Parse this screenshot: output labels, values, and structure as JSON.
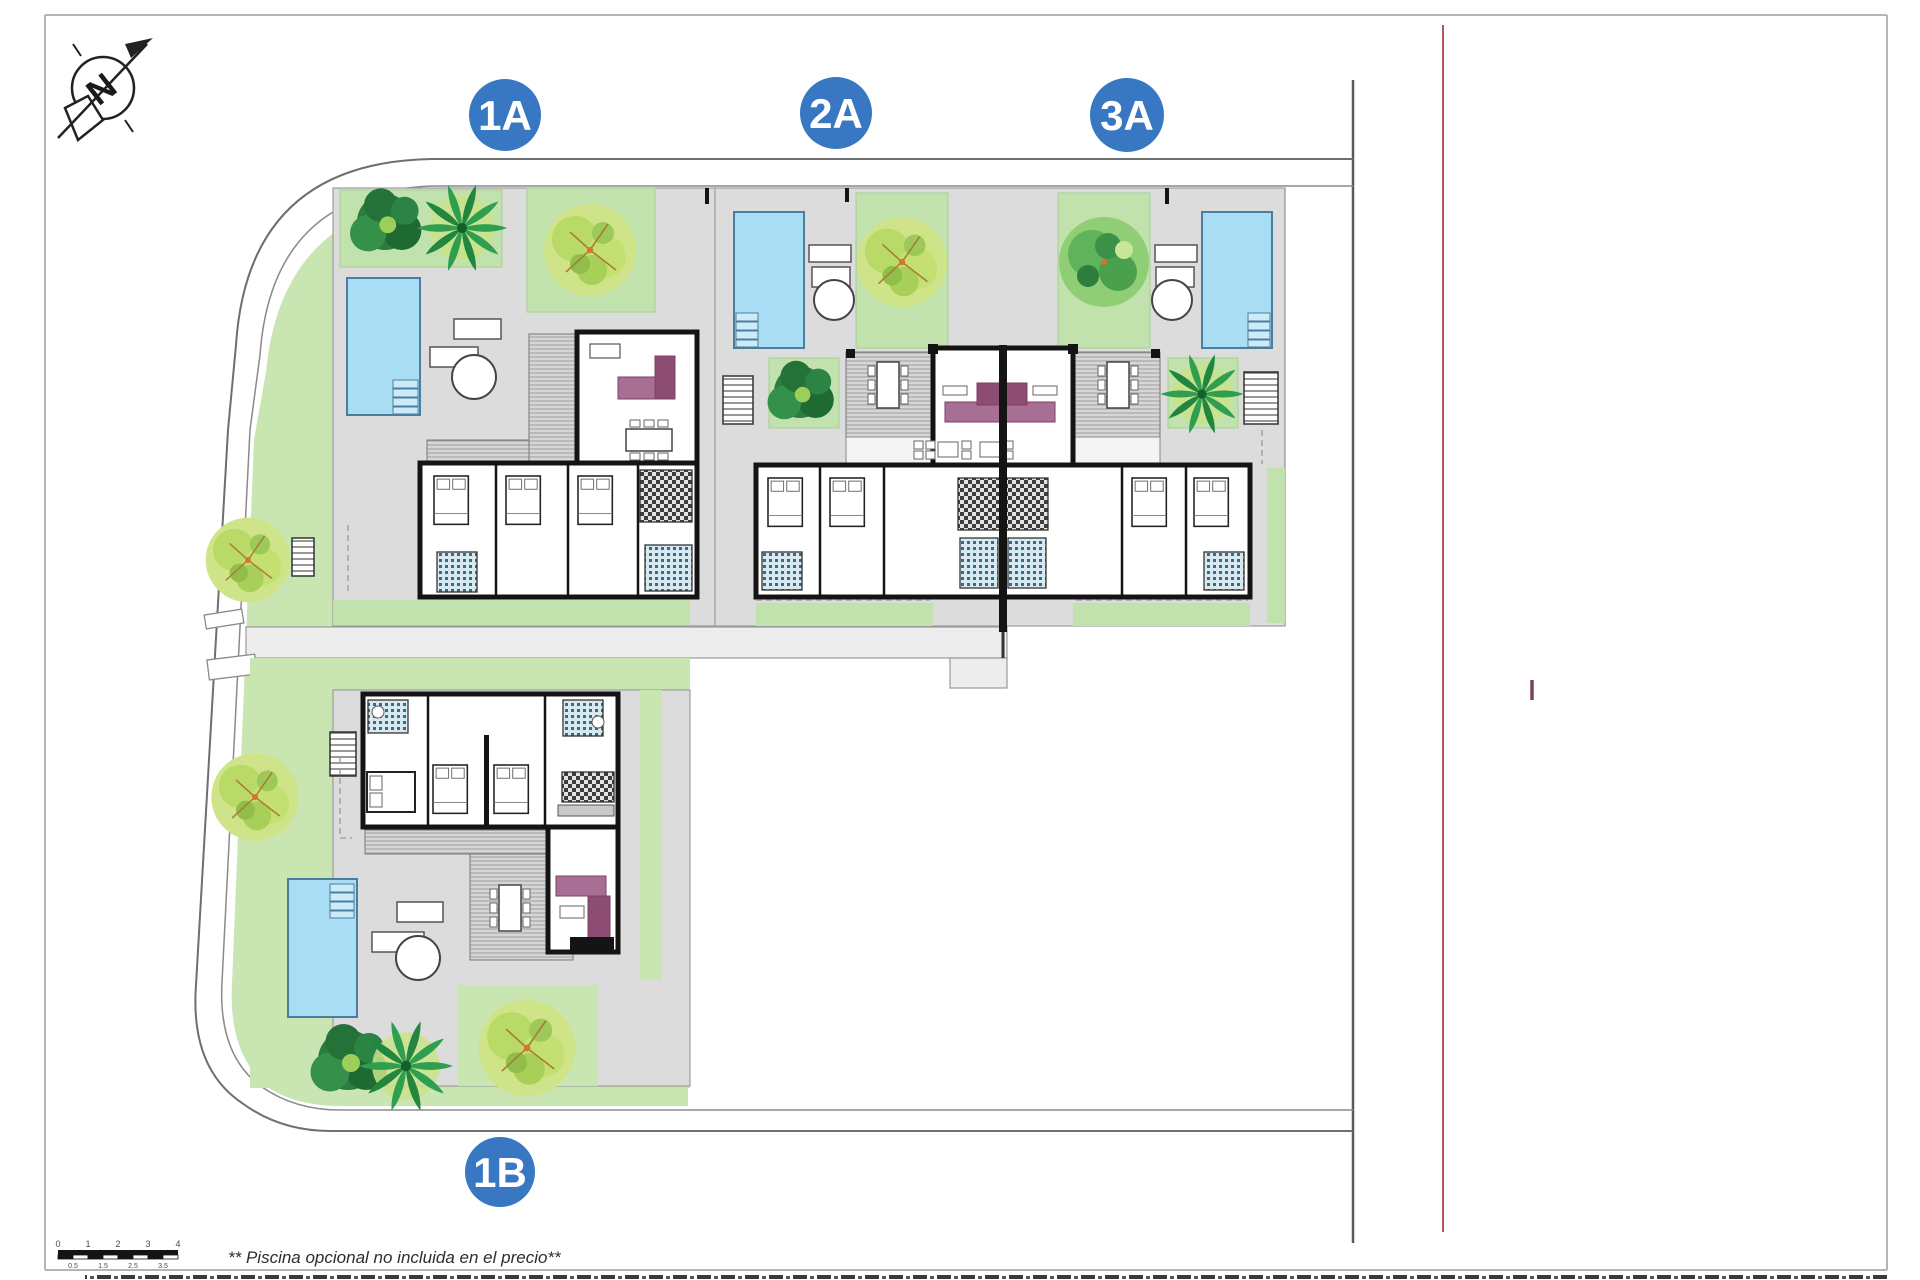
{
  "site_plan": {
    "title": "villa-site-plan",
    "units": [
      {
        "id": "unit-1a",
        "label": "1A"
      },
      {
        "id": "unit-2a",
        "label": "2A"
      },
      {
        "id": "unit-3a",
        "label": "3A"
      },
      {
        "id": "unit-1b",
        "label": "1B"
      }
    ],
    "compass": {
      "north_letter": "N"
    },
    "scale_bar": {
      "major_ticks": [
        "0",
        "1",
        "2",
        "3",
        "4"
      ],
      "minor_ticks": [
        "0.5",
        "1.5",
        "2.5",
        "3.5"
      ]
    },
    "footnote": "** Piscina opcional no incluida en el precio**",
    "colors": {
      "unit_badge_blue": "#3878c2",
      "pool_blue": "#a8ddf3",
      "garden_green": "#c8e5b2",
      "paving_gray": "#dcdcdc",
      "sofa_mauve": "#a86f94",
      "marker_red": "#b2555f",
      "wall_black": "#141414"
    }
  }
}
